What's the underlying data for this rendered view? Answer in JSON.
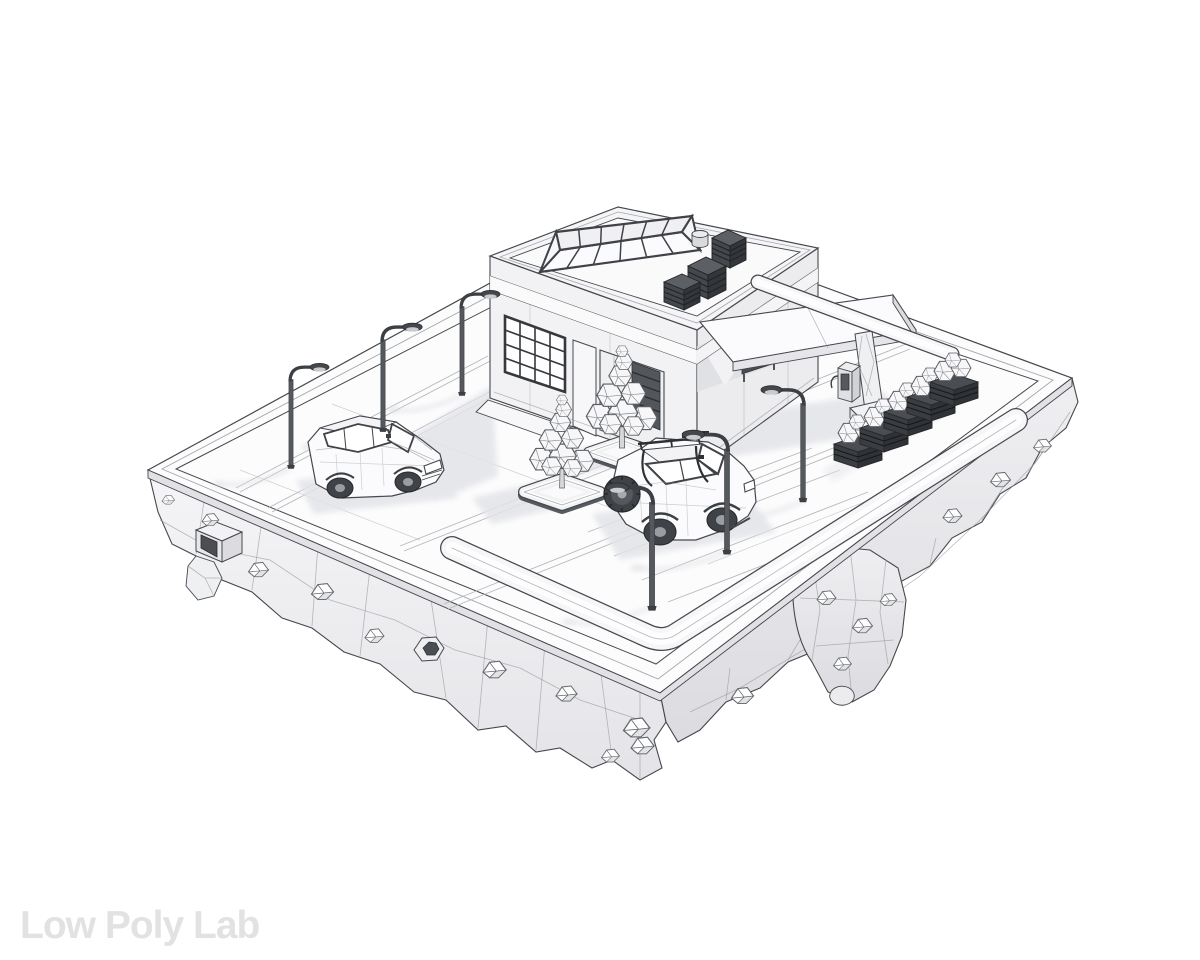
{
  "window": {
    "width": 1200,
    "height": 960
  },
  "watermark": {
    "text": "Low Poly Lab"
  },
  "palette": {
    "background": "#ffffff",
    "line": "#45484c",
    "line-soft": "#92979c",
    "surface": "#fcfcfd",
    "face-light": "#f3f3f5",
    "face-mid": "#e9e9ec",
    "face-dark": "#dfe0e3",
    "shadow": "#e3e4e8",
    "dark": "#3c3f43",
    "darker": "#2b2d30",
    "watermark": "#e2e2e3"
  },
  "scene": {
    "type": "3d-wireframe-render",
    "subject": "low-poly gas station diorama on a floating rock island",
    "objects": [
      "floating-island",
      "left-cliff",
      "right-cliff",
      "rock-outcrop",
      "drain-duct",
      "drain-pipe",
      "embedded-crystals",
      "perimeter-curb",
      "front-sidewalk",
      "back-sidewalk",
      "gas-station-building",
      "roof-skylight",
      "hvac-units",
      "roof-vent",
      "shop-window",
      "entrance",
      "wall-bench",
      "fuel-canopy",
      "canopy-column",
      "fuel-pump",
      "tree-1",
      "tree-2",
      "tree-planter-1",
      "tree-planter-2",
      "hatchback-car",
      "suv-car",
      "street-lamp-1",
      "street-lamp-2",
      "street-lamp-3",
      "street-lamp-4",
      "street-lamp-5",
      "street-lamp-6",
      "bush-planter-1",
      "bush-planter-2",
      "bush-planter-3",
      "bush-planter-4",
      "bush-planter-5",
      "parking-lines",
      "cast-shadows"
    ]
  }
}
